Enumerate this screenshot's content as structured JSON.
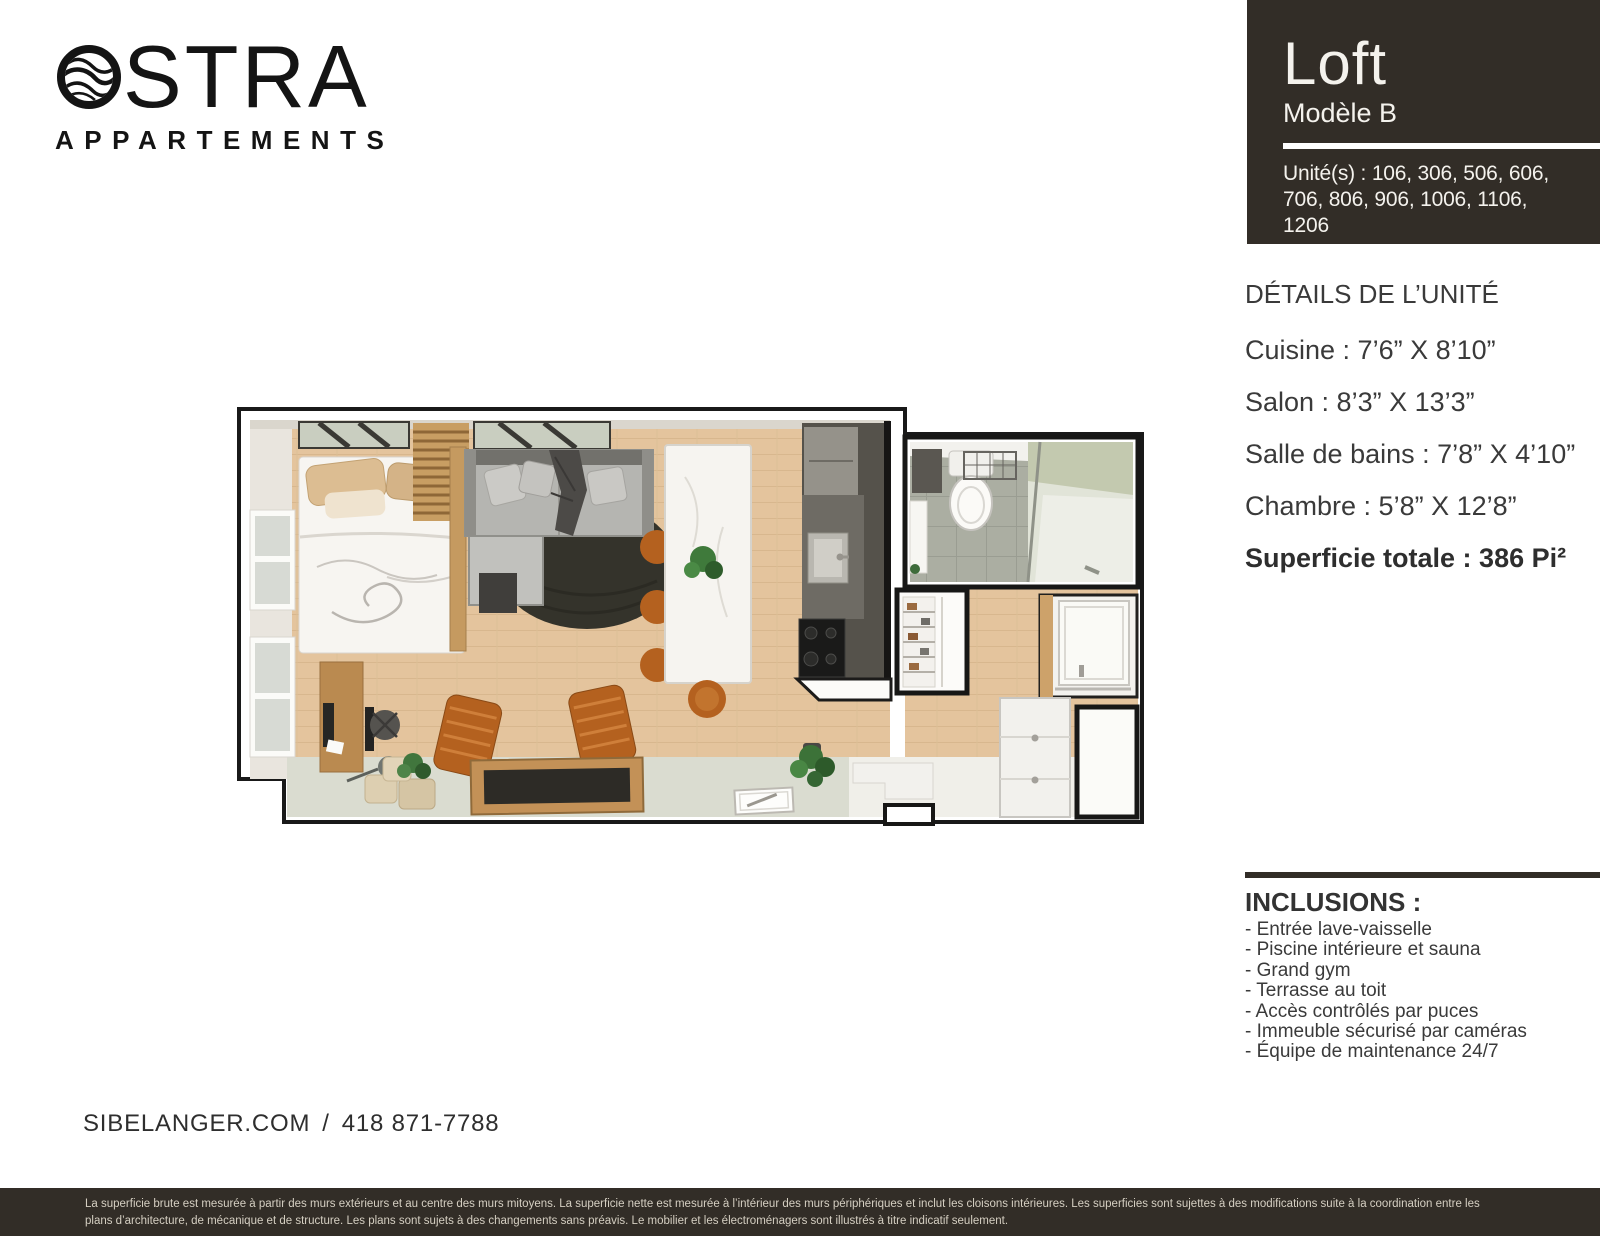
{
  "brand": {
    "name": "OSTRA",
    "suffix": "STRA",
    "subtitle": "APPARTEMENTS"
  },
  "unit_card": {
    "title": "Loft",
    "model": "Modèle B",
    "units_lines": [
      "Unité(s) : 106, 306, 506, 606,",
      "706, 806, 906, 1006, 1106,",
      "1206"
    ],
    "bg_color": "#322d27"
  },
  "details": {
    "title": "DÉTAILS DE L’UNITÉ",
    "rooms": [
      "Cuisine : 7’6” X 8’10”",
      "Salon : 8’3” X 13’3”",
      "Salle de bains : 7’8” X 4’10”",
      "Chambre : 5’8” X 12’8”"
    ],
    "total": "Superficie totale : 386 Pi²"
  },
  "inclusions": {
    "title": "INCLUSIONS :",
    "items": [
      "- Entrée lave-vaisselle",
      "- Piscine intérieure et sauna",
      "- Grand gym",
      "- Terrasse au toit",
      "- Accès contrôlés par puces",
      "- Immeuble sécurisé par caméras",
      "- Équipe de maintenance 24/7"
    ]
  },
  "contact": {
    "website": "SIBELANGER.COM",
    "separator": "/",
    "phone": "418 871-7788"
  },
  "footer": {
    "lines": [
      "La superficie brute est mesurée à partir des murs extérieurs et au centre des murs mitoyens. La superficie nette est mesurée à l’intérieur des murs périphériques et inclut les cloisons intérieures. Les superficies sont sujettes à des modifications suite à la coordination entre les",
      "plans d’architecture, de mécanique et de structure. Les plans sont sujets à des changements sans préavis. Le mobilier et les électroménagers sont illustrés à titre indicatif seulement."
    ],
    "bg_color": "#322d27"
  },
  "floor_plan": {
    "description": "3D top-down rendering of the loft unit: bedroom, living room, kitchen, bathroom and entry"
  }
}
